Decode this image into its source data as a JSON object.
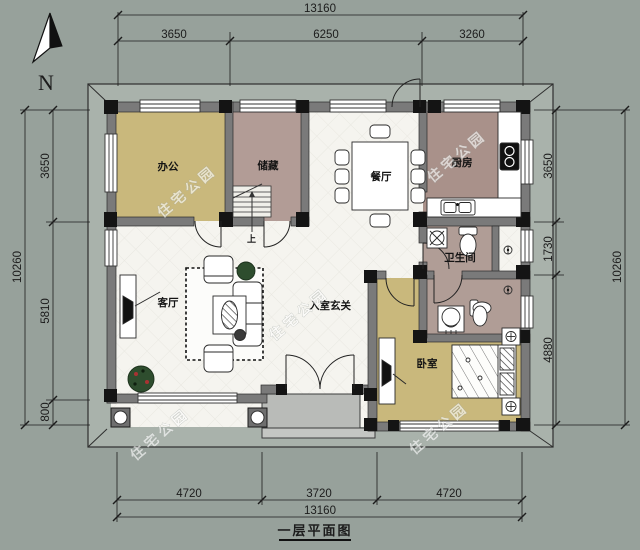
{
  "meta": {
    "caption": "一层平面图",
    "north_label": "N",
    "watermark_text": "住宅公园",
    "stairs_up_label": "上"
  },
  "dimensions": {
    "top": {
      "total": "13160",
      "segments": [
        "3650",
        "6250",
        "3260"
      ]
    },
    "bottom": {
      "total": "13160",
      "segments": [
        "4720",
        "3720",
        "4720"
      ]
    },
    "left": {
      "total": "10260",
      "segments": [
        "3650",
        "5810",
        "800"
      ]
    },
    "right": {
      "total": "10260",
      "segments": [
        "3650",
        "1730",
        "4880"
      ]
    }
  },
  "rooms": {
    "office": {
      "label": "办公"
    },
    "storage": {
      "label": "储藏"
    },
    "dining": {
      "label": "餐厅"
    },
    "kitchen": {
      "label": "厨房"
    },
    "bathroom": {
      "label": "卫生间"
    },
    "living": {
      "label": "客厅"
    },
    "foyer": {
      "label": "入室玄关"
    },
    "bedroom": {
      "label": "卧室"
    }
  },
  "colors": {
    "background": "#97a19b",
    "eave_band": "#a9b2ab",
    "wall_gray": "#7a7a7a",
    "pier_black": "#141414",
    "floor_white": "#f5f4ef",
    "floor_tan": "#c9b87c",
    "floor_mauve": "#b29c96",
    "floor_kitchen": "#a9918a",
    "porch_gray": "#b9bbb8",
    "plant_green": "#2e4d2e"
  }
}
